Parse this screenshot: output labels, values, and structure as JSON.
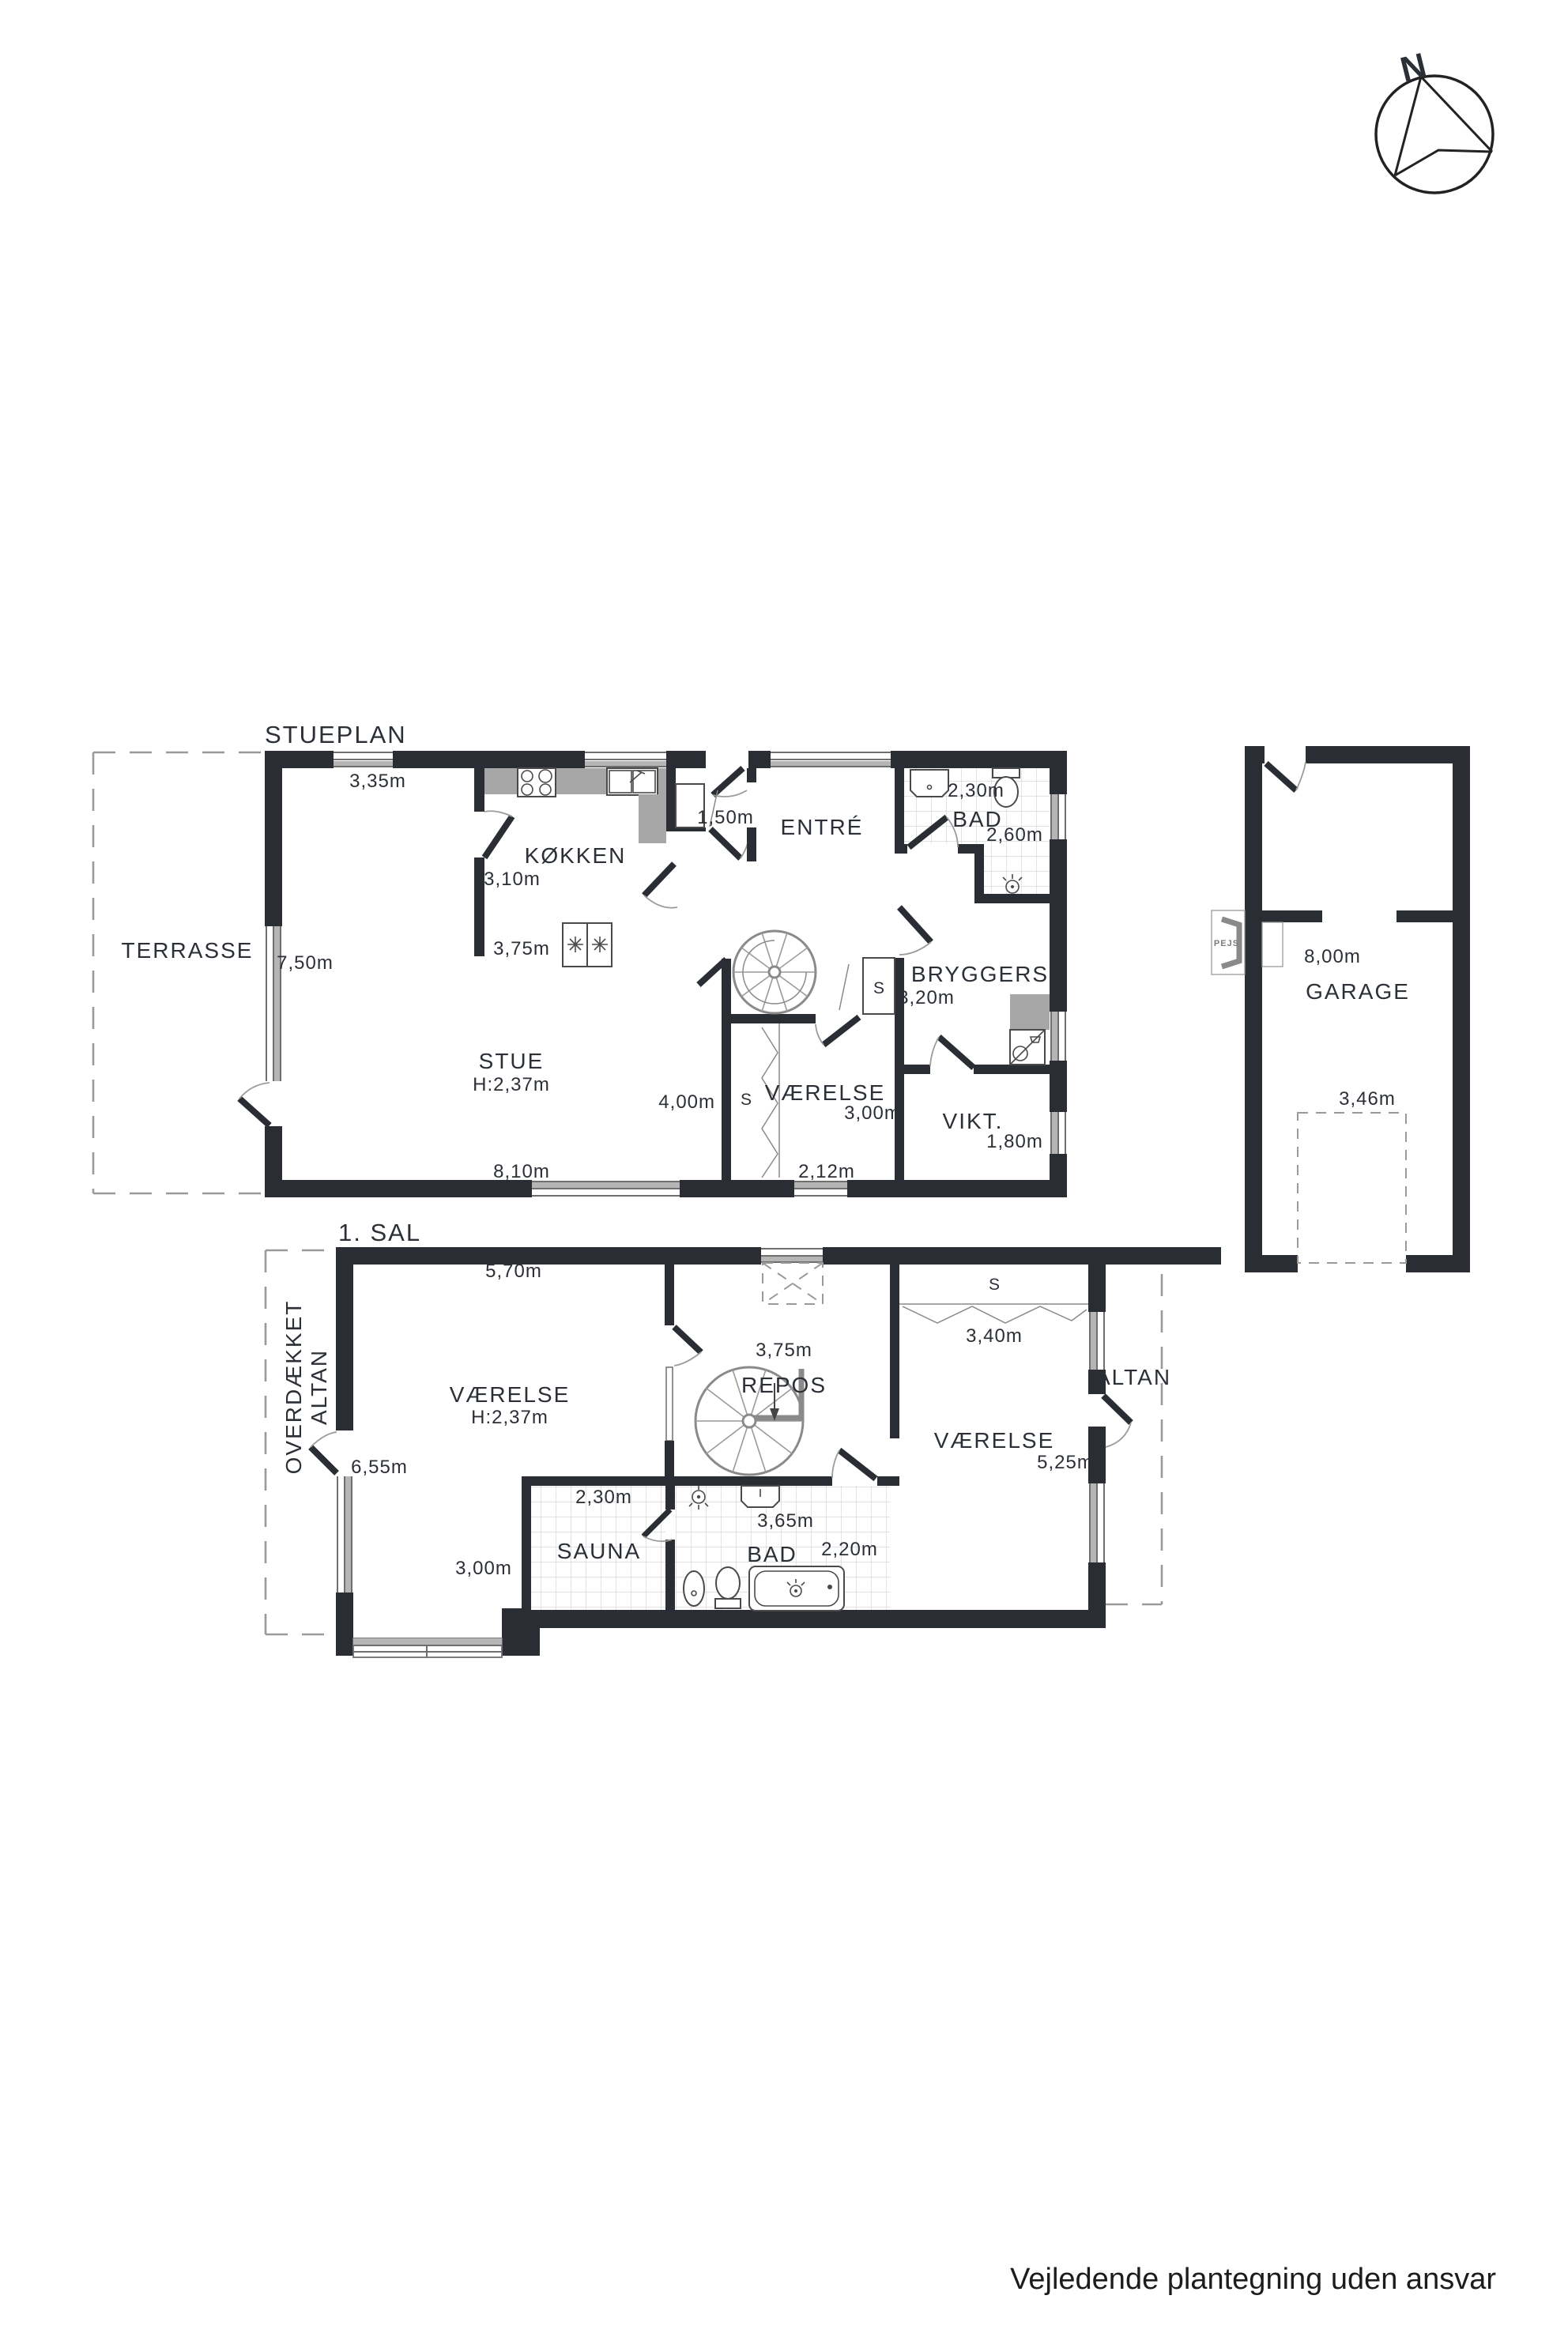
{
  "compass": {
    "north": "N"
  },
  "ground_floor": {
    "plan_label": "STUEPLAN",
    "terrasse": {
      "name": "TERRASSE",
      "width": "7,50m"
    },
    "stue": {
      "name": "STUE",
      "ceiling": "H:2,37m",
      "width": "8,10m",
      "depth": "4,00m"
    },
    "kokken": {
      "name": "KØKKEN",
      "top": "3,35m",
      "left": "3,10m",
      "bottom": "3,75m"
    },
    "entre": {
      "name": "ENTRÉ",
      "vindfang": "1,50m"
    },
    "bad": {
      "name": "BAD",
      "width": "2,30m",
      "depth": "2,60m"
    },
    "bryggers": {
      "name": "BRYGGERS",
      "width": "3,20m"
    },
    "vikt": {
      "name": "VIKT.",
      "width": "1,80m"
    },
    "vaerelse": {
      "name": "VÆRELSE",
      "width": "3,00m",
      "window": "2,12m"
    },
    "closet_stair": "S",
    "closet_vaerelse": "S"
  },
  "garage": {
    "name": "GARAGE",
    "depth": "8,00m",
    "width": "3,46m",
    "pejs_label": "PEJS"
  },
  "first_floor": {
    "plan_label": "1. SAL",
    "covered_balcony": {
      "line1": "OVERDÆKKET",
      "line2": "ALTAN"
    },
    "vaerelse_left": {
      "name": "VÆRELSE",
      "ceiling": "H:2,37m",
      "top": "5,70m",
      "left": "6,55m",
      "bottom": "3,00m"
    },
    "repos": {
      "name": "REPOS",
      "skylight": "3,75m"
    },
    "closet": {
      "label": "S",
      "width": "3,40m"
    },
    "altan": {
      "name": "ALTAN"
    },
    "vaerelse_right": {
      "name": "VÆRELSE",
      "depth": "5,25m"
    },
    "sauna": {
      "name": "SAUNA",
      "width": "2,30m"
    },
    "bad": {
      "name": "BAD",
      "width": "3,65m",
      "depth": "2,20m"
    }
  },
  "footer": {
    "note": "Vejledende plantegning uden ansvar"
  }
}
